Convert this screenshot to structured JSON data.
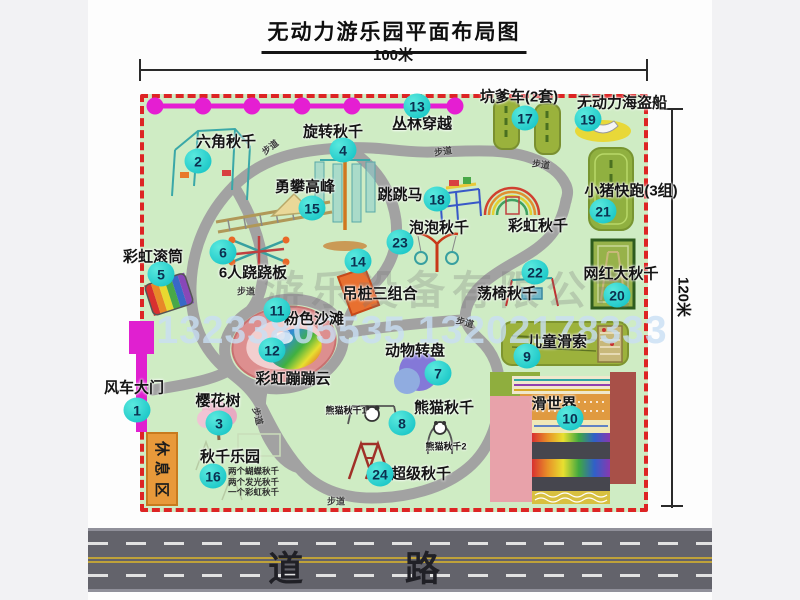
{
  "title": "无动力游乐园平面布局图",
  "dimensions": {
    "width_label": "100米",
    "height_label": "120米"
  },
  "road": {
    "label": "道 路"
  },
  "watermark": {
    "company": "游乐设备有限公司",
    "phone": "13233805535 13202178333"
  },
  "rest_area": {
    "label": "休息区"
  },
  "swing_park_notes": [
    "两个蝴蝶秋千",
    "两个发光秋千",
    "一个彩虹秋千"
  ],
  "colors": {
    "map_bg": "#cfecc4",
    "border_dash": "#dd2424",
    "badge": "#1fc9c9",
    "chain": "#e51ed2",
    "path_gray": "#a2a2a2",
    "road": "#63636b",
    "rest_area_orange": "#e8993a",
    "gate_magenta": "#e020d0"
  },
  "attractions": [
    {
      "num": "1",
      "label": "风车大门",
      "nx": 137,
      "ny": 410,
      "lx": 134,
      "ly": 387
    },
    {
      "num": "2",
      "label": "六角秋千",
      "nx": 198,
      "ny": 161,
      "lx": 226,
      "ly": 141
    },
    {
      "num": "3",
      "label": "樱花树",
      "nx": 219,
      "ny": 423,
      "lx": 218,
      "ly": 400
    },
    {
      "num": "4",
      "label": "旋转秋千",
      "nx": 343,
      "ny": 150,
      "lx": 333,
      "ly": 131
    },
    {
      "num": "5",
      "label": "彩虹滚筒",
      "nx": 161,
      "ny": 274,
      "lx": 153,
      "ly": 256
    },
    {
      "num": "6",
      "label": "6人跷跷板",
      "nx": 223,
      "ny": 252,
      "lx": 253,
      "ly": 272
    },
    {
      "num": "7",
      "label": "动物转盘",
      "nx": 438,
      "ny": 373,
      "lx": 415,
      "ly": 350
    },
    {
      "num": "8",
      "label": "熊猫秋千",
      "nx": 402,
      "ny": 423,
      "lx": 444,
      "ly": 407
    },
    {
      "num": "9",
      "label": "儿童滑索",
      "nx": 527,
      "ny": 356,
      "lx": 557,
      "ly": 341
    },
    {
      "num": "10",
      "label": "滑世界",
      "nx": 570,
      "ny": 418,
      "lx": 554,
      "ly": 403
    },
    {
      "num": "11",
      "label": "粉色沙滩",
      "nx": 277,
      "ny": 310,
      "lx": 314,
      "ly": 318
    },
    {
      "num": "12",
      "label": "彩虹蹦蹦云",
      "nx": 272,
      "ny": 350,
      "lx": 293,
      "ly": 378
    },
    {
      "num": "13",
      "label": "丛林穿越",
      "nx": 417,
      "ny": 106,
      "lx": 422,
      "ly": 123
    },
    {
      "num": "14",
      "label": "吊桩三组合",
      "nx": 358,
      "ny": 261,
      "lx": 380,
      "ly": 293
    },
    {
      "num": "15",
      "label": "勇攀高峰",
      "nx": 312,
      "ny": 208,
      "lx": 305,
      "ly": 186
    },
    {
      "num": "16",
      "label": "秋千乐园",
      "nx": 213,
      "ny": 476,
      "lx": 230,
      "ly": 456
    },
    {
      "num": "17",
      "label": "坑爹车(2套)",
      "nx": 525,
      "ny": 118,
      "lx": 519,
      "ly": 96
    },
    {
      "num": "18",
      "label": "跳跳马",
      "nx": 437,
      "ny": 199,
      "lx": 400,
      "ly": 194
    },
    {
      "num": "19",
      "label": "无动力海盗船",
      "nx": 588,
      "ny": 119,
      "lx": 622,
      "ly": 102
    },
    {
      "num": "20",
      "label": "网红大秋千",
      "nx": 617,
      "ny": 295,
      "lx": 621,
      "ly": 273
    },
    {
      "num": "21",
      "label": "小猪快跑(3组)",
      "nx": 603,
      "ny": 211,
      "lx": 631,
      "ly": 190
    },
    {
      "num": "22",
      "label": "荡椅秋千",
      "nx": 535,
      "ny": 272,
      "lx": 507,
      "ly": 293
    },
    {
      "num": "23",
      "label": "泡泡秋千",
      "nx": 400,
      "ny": 242,
      "lx": 439,
      "ly": 227
    },
    {
      "num": "24",
      "label": "超级秋千",
      "nx": 380,
      "ny": 474,
      "lx": 421,
      "ly": 473
    }
  ],
  "extra_labels": [
    {
      "text": "彩虹秋千",
      "x": 538,
      "y": 225,
      "size": 15
    },
    {
      "text": "熊猫秋千1",
      "x": 346,
      "y": 410,
      "size": 9
    },
    {
      "text": "熊猫秋千2",
      "x": 446,
      "y": 446,
      "size": 9
    }
  ],
  "path_labels": [
    {
      "text": "步道",
      "x": 270,
      "y": 147,
      "rot": -38
    },
    {
      "text": "步道",
      "x": 443,
      "y": 151,
      "rot": -8
    },
    {
      "text": "步道",
      "x": 541,
      "y": 164,
      "rot": 8
    },
    {
      "text": "步道",
      "x": 246,
      "y": 291,
      "rot": 0
    },
    {
      "text": "步道",
      "x": 465,
      "y": 322,
      "rot": 15
    },
    {
      "text": "步道",
      "x": 258,
      "y": 416,
      "rot": 75
    },
    {
      "text": "步道",
      "x": 336,
      "y": 501,
      "rot": 0
    }
  ]
}
